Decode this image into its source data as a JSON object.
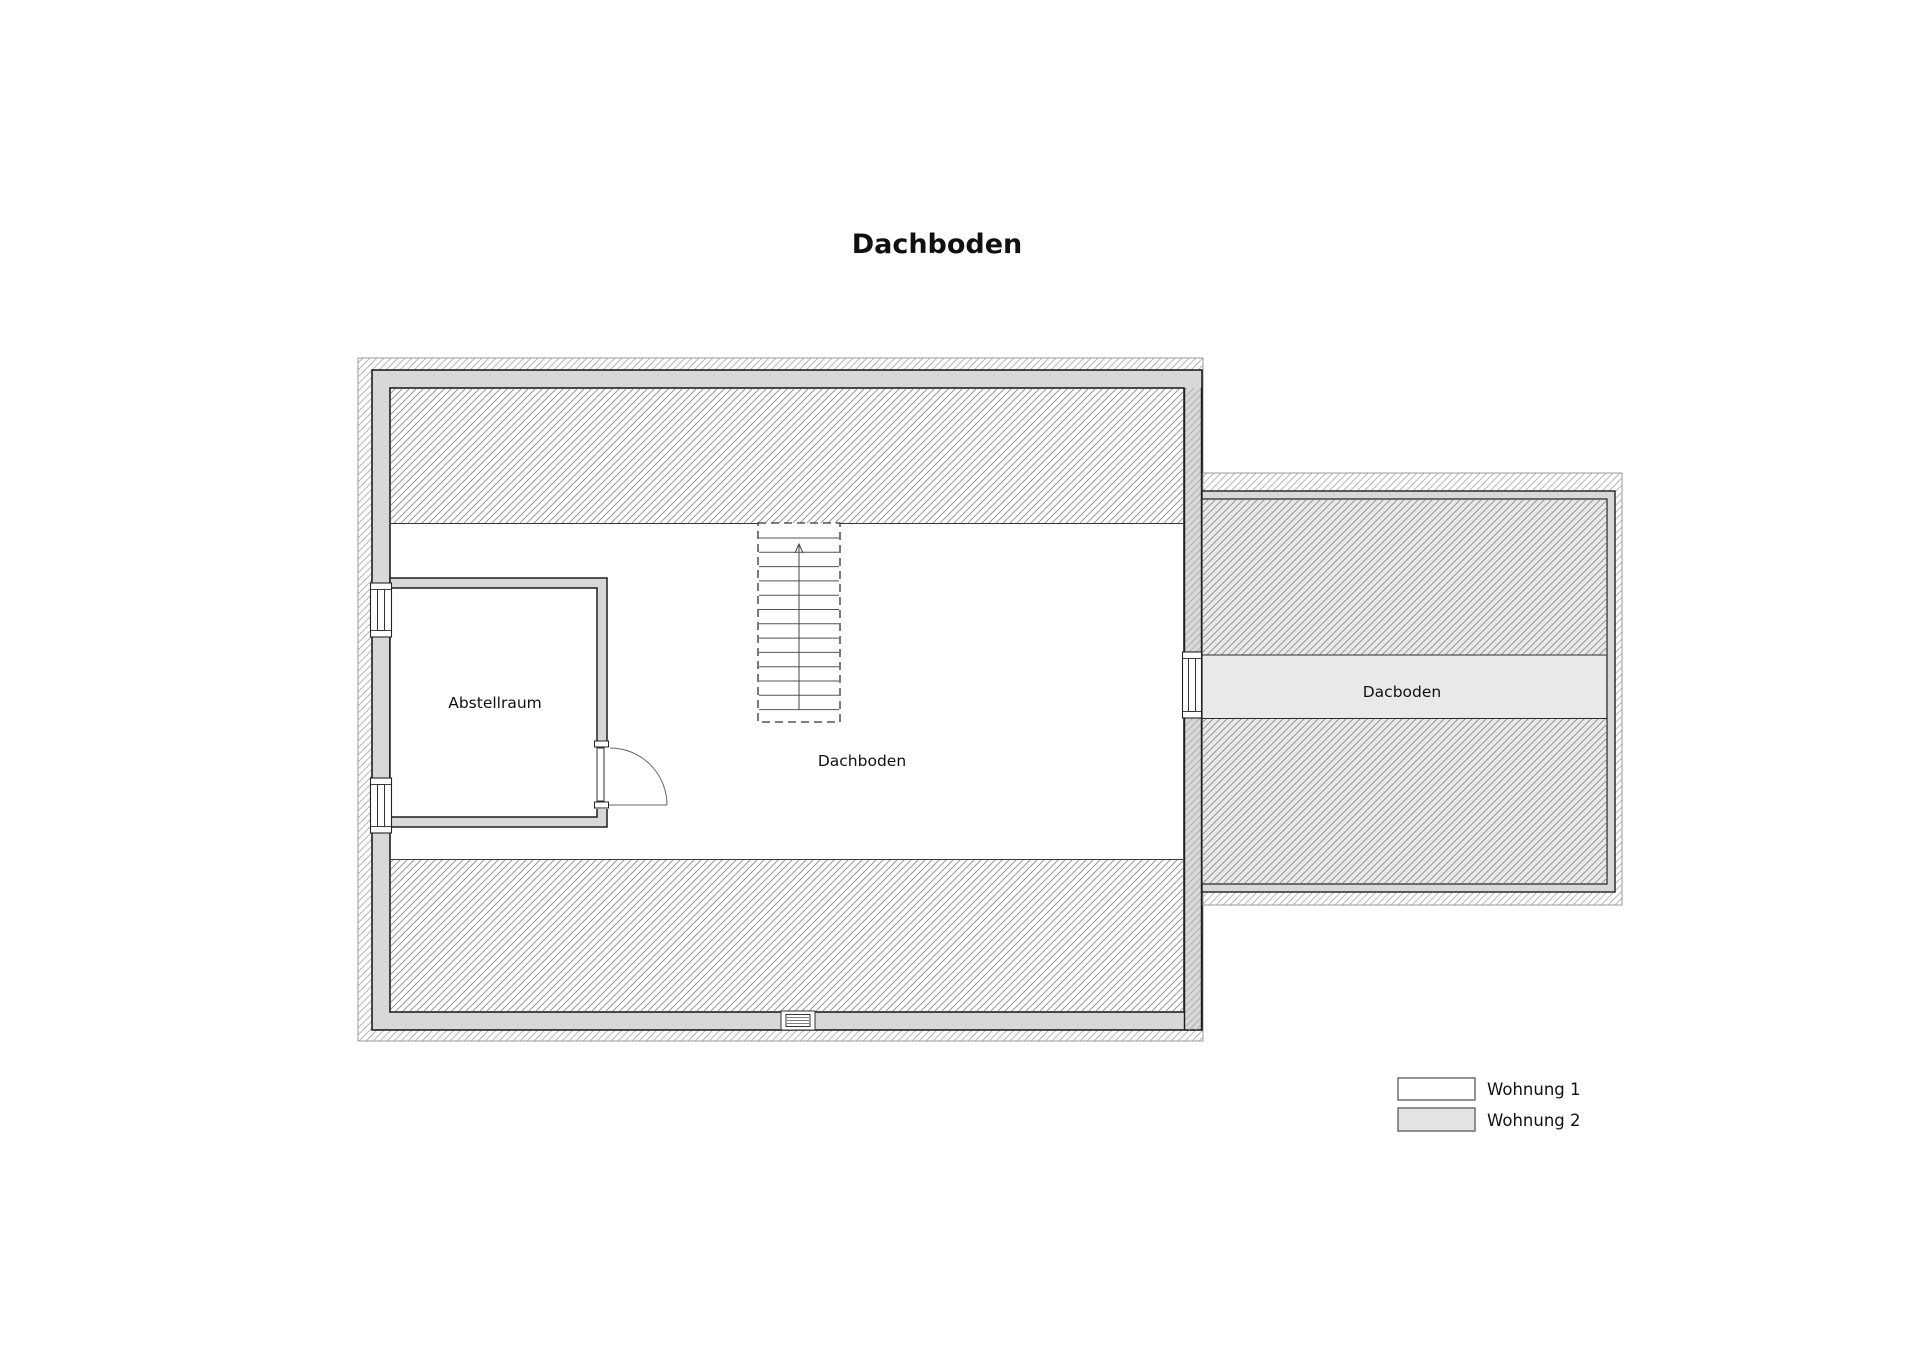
{
  "page": {
    "title": "Dachboden"
  },
  "plan": {
    "labels": {
      "abstellraum": "Abstellraum",
      "main_attic": "Dachboden",
      "extension_attic": "Dacboden"
    },
    "colors": {
      "wall_fill": "#d8d8d8",
      "wall_outline": "#1e1e1e",
      "overhang_boundary": "#9b9b9b",
      "hatch_line_light": "#a8a8a8",
      "hatch_line_dense": "#8d8d8d",
      "apartment1_fill": "#ffffff",
      "apartment2_fill": "#e9e9e9"
    }
  },
  "legend": {
    "items": [
      {
        "label": "Wohnung 1",
        "swatch": "#ffffff",
        "border": "#6e6e6e"
      },
      {
        "label": "Wohnung 2",
        "swatch": "#e3e3e3",
        "border": "#6e6e6e"
      }
    ]
  }
}
